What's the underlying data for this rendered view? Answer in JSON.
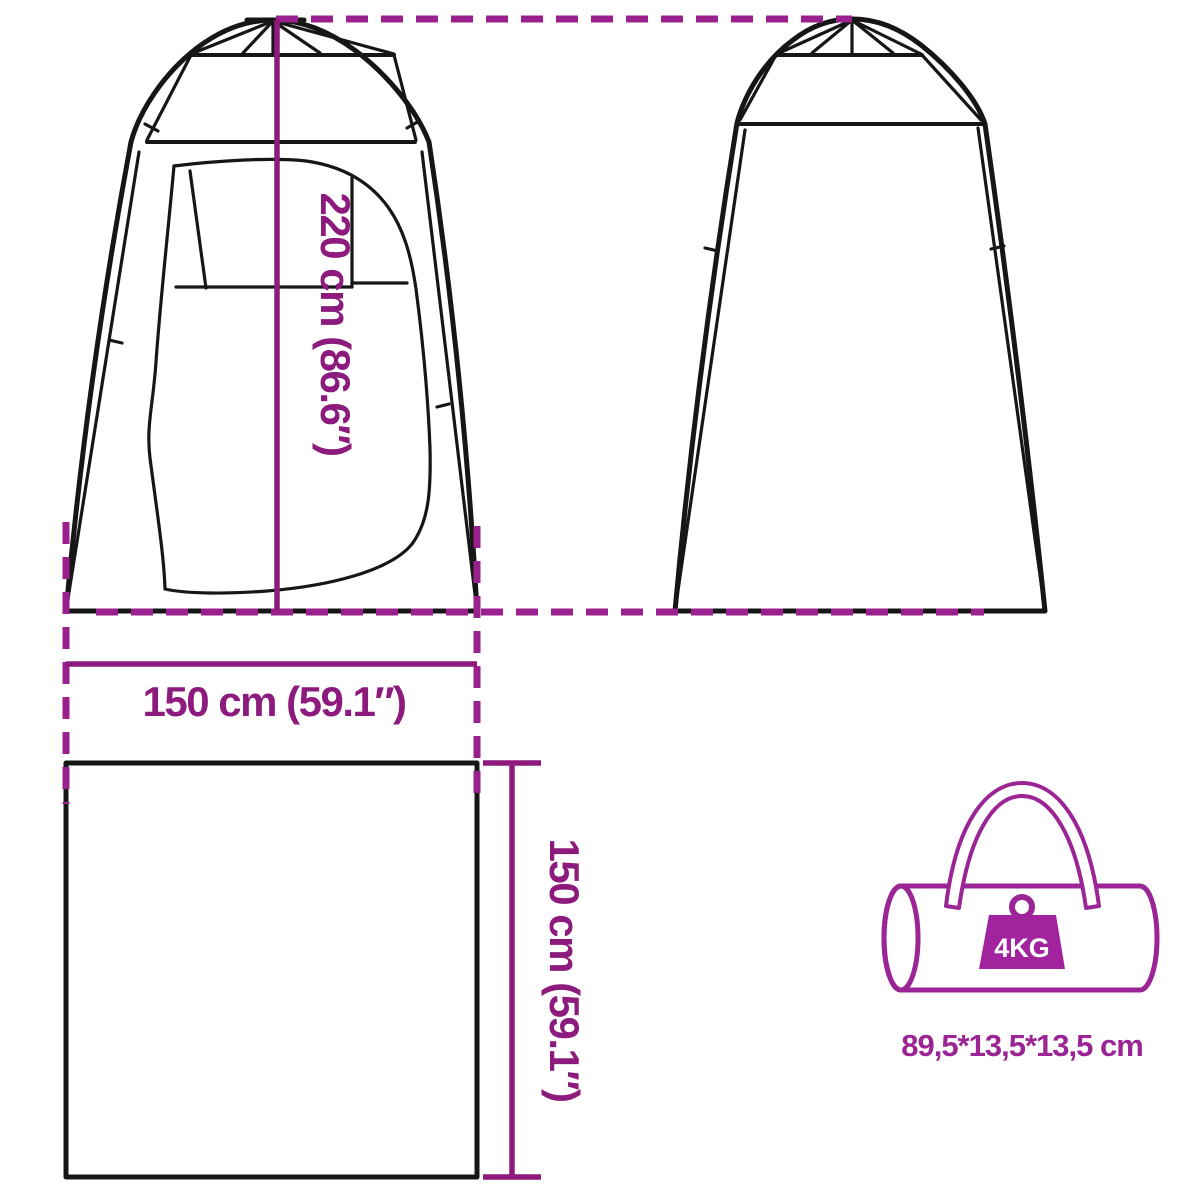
{
  "labels": {
    "tent_height": "220 cm (86.6″)",
    "tent_width": "150 cm (59.1″)",
    "floor_depth": "150 cm (59.1″)",
    "bag_weight": "4KG",
    "bag_size": "89,5*13,5*13,5 cm"
  },
  "dimensions": {
    "height_cm": "220",
    "height_in": "86.6",
    "width_cm": "150",
    "width_in": "59.1",
    "depth_cm": "150",
    "depth_in": "59.1",
    "bag_weight_kg": "4",
    "bag_size_cm": "89,5*13,5*13,5"
  },
  "colors": {
    "line_black": "#161616",
    "dimension_purple": "#8d1a7d",
    "dash_purple": "#99208d",
    "bag_purple": "#9c2595",
    "weight_fill": "#a2239e",
    "weight_text_color": "#ffffff"
  },
  "icons": {
    "front_view": "tent-front-view-icon",
    "back_view": "tent-back-view-icon",
    "floor_plan": "floor-plan-square-icon",
    "carry_bag": "carry-bag-icon",
    "weight": "weight-icon"
  }
}
